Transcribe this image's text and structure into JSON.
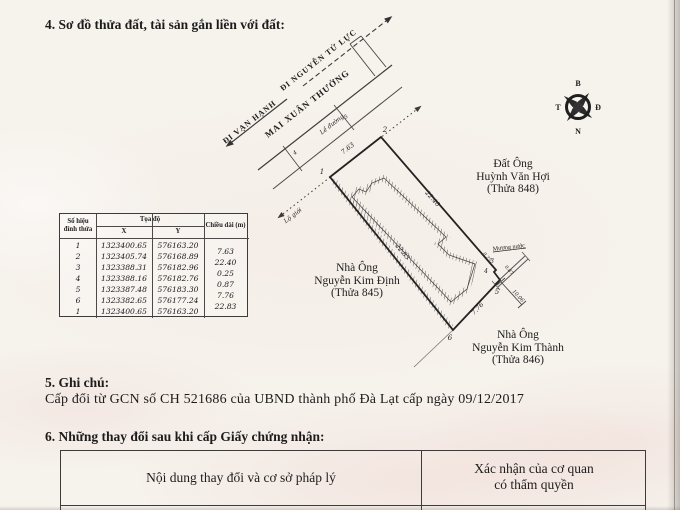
{
  "page": {
    "section4_title": "4. Sơ đồ thửa đất, tài sản gắn liền với đất:",
    "section5_title": "5. Ghi chú:",
    "section5_body": "Cấp đổi từ GCN số CH 521686 của UBND thành phố Đà Lạt cấp ngày 09/12/2017",
    "section6_title": "6. Những thay đổi sau khi cấp Giấy chứng nhận:"
  },
  "diagram": {
    "roads": {
      "van_hanh": "ĐI VẠN HẠNH",
      "nguyen_tu_luc": "ĐI NGUYỄN TỬ LỰC",
      "street": "MAI XUÂN THƯỞNG",
      "le_duong": "Lề đường",
      "lo_gioi": "Lộ giới"
    },
    "water_channel": "Mương nước",
    "neighbor_right": [
      "Đất Ông",
      "Huỳnh Văn Hợi",
      "(Thửa 848)"
    ],
    "neighbor_left": [
      "Nhà Ông",
      "Nguyễn Kim Định",
      "(Thửa 845)"
    ],
    "neighbor_bottom": [
      "Nhà Ông",
      "Nguyễn Kim Thành",
      "(Thửa 846)"
    ],
    "edge_lengths": {
      "e12": "7.63",
      "e23": "22.40",
      "e34": "0.25",
      "e45": "0.87",
      "e56": "7.76",
      "e61": "22.83",
      "branch": "10.06"
    },
    "vertices": [
      "1",
      "2",
      "3",
      "4",
      "5",
      "6"
    ],
    "ticks": [
      "4",
      "5"
    ],
    "compass": {
      "north": "B",
      "east": "Đ",
      "south": "N",
      "west": "T"
    }
  },
  "coord_table": {
    "header_vertex_l1": "Số hiệu",
    "header_vertex_l2": "đỉnh thửa",
    "header_coord": "Tọa độ",
    "header_x": "X",
    "header_y": "Y",
    "header_length": "Chiều dài (m)",
    "rows": [
      {
        "id": "1",
        "x": "1323400.65",
        "y": "576163.20"
      },
      {
        "id": "2",
        "x": "1323405.74",
        "y": "576168.89"
      },
      {
        "id": "3",
        "x": "1323388.31",
        "y": "576182.96"
      },
      {
        "id": "4",
        "x": "1323388.16",
        "y": "576182.76"
      },
      {
        "id": "5",
        "x": "1323387.48",
        "y": "576183.30"
      },
      {
        "id": "6",
        "x": "1323382.65",
        "y": "576177.24"
      },
      {
        "id": "1",
        "x": "1323400.65",
        "y": "576163.20"
      }
    ],
    "lengths": [
      "7.63",
      "22.40",
      "0.25",
      "0.87",
      "7.76",
      "22.83"
    ]
  },
  "change_table": {
    "col1_header": "Nội dung thay đổi và cơ sở pháp lý",
    "col2_header_l1": "Xác nhận của cơ quan",
    "col2_header_l2": "có thẩm quyền"
  }
}
